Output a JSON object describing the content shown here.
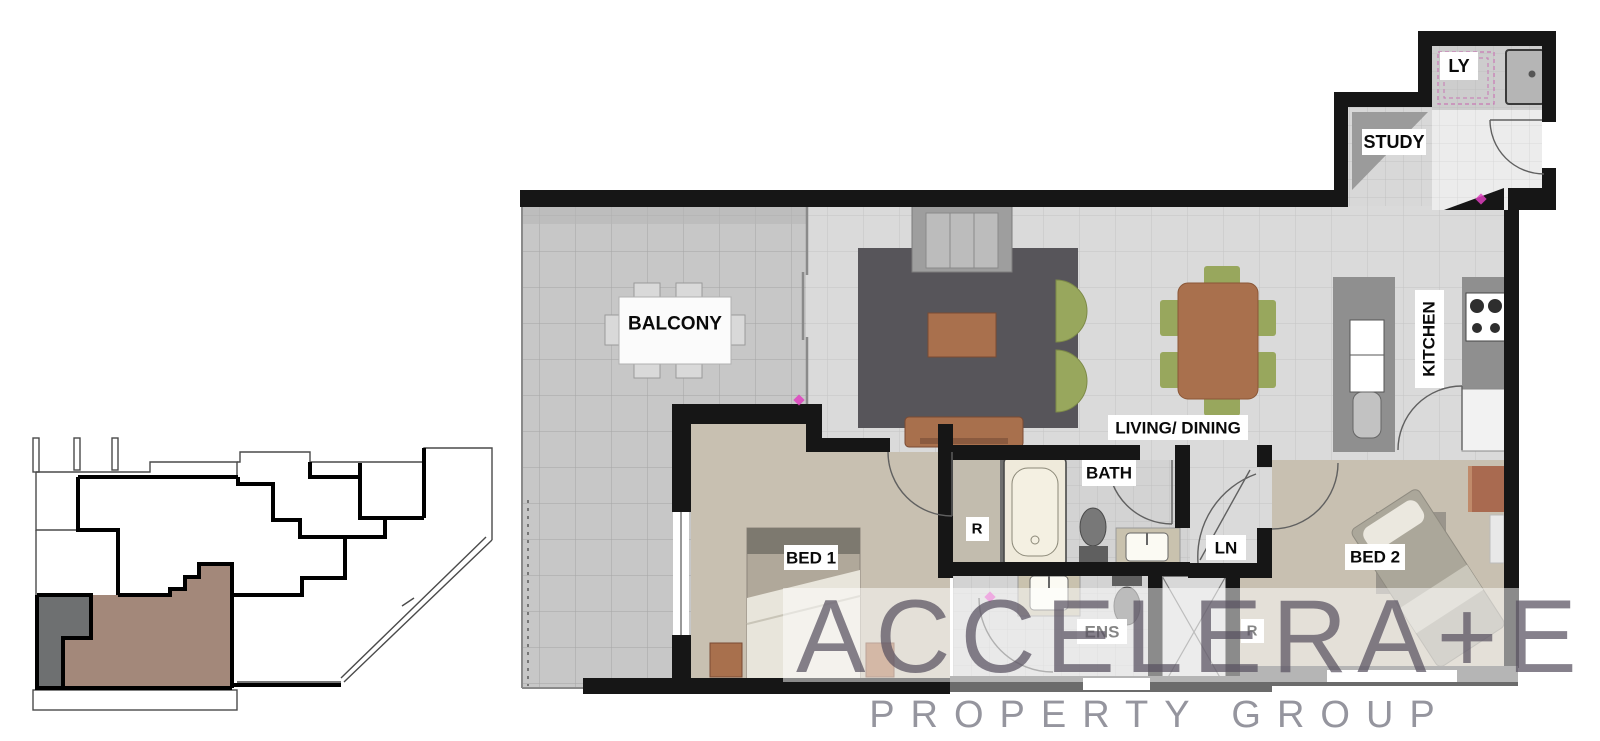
{
  "floor_plan": {
    "rooms": {
      "balcony": "BALCONY",
      "living_dining": "LIVING/ DINING",
      "kitchen": "KITCHEN",
      "study": "STUDY",
      "laundry": "LY",
      "bath": "BATH",
      "ensuite": "ENS",
      "linen": "LN",
      "bed1": "BED 1",
      "bed2": "BED 2",
      "robe_bed1": "R",
      "robe_bed2": "R"
    },
    "watermark": {
      "brand": "ACCELERA+E",
      "tagline": "PROPERTY GROUP"
    },
    "colors": {
      "wall": "#161616",
      "balcony_floor": "#c7c7c7",
      "living_floor": "#dadada",
      "bedroom_floor": "#c8c0b1",
      "rug": "#57555a",
      "timber_furniture": "#a9704d",
      "chair_green": "#98a75d",
      "bath_fixture_cream": "#efeadb",
      "key_plan_unit_brown": "#a3887a",
      "key_plan_unit_grey": "#6e7071",
      "watermark_text": "#575060"
    }
  }
}
